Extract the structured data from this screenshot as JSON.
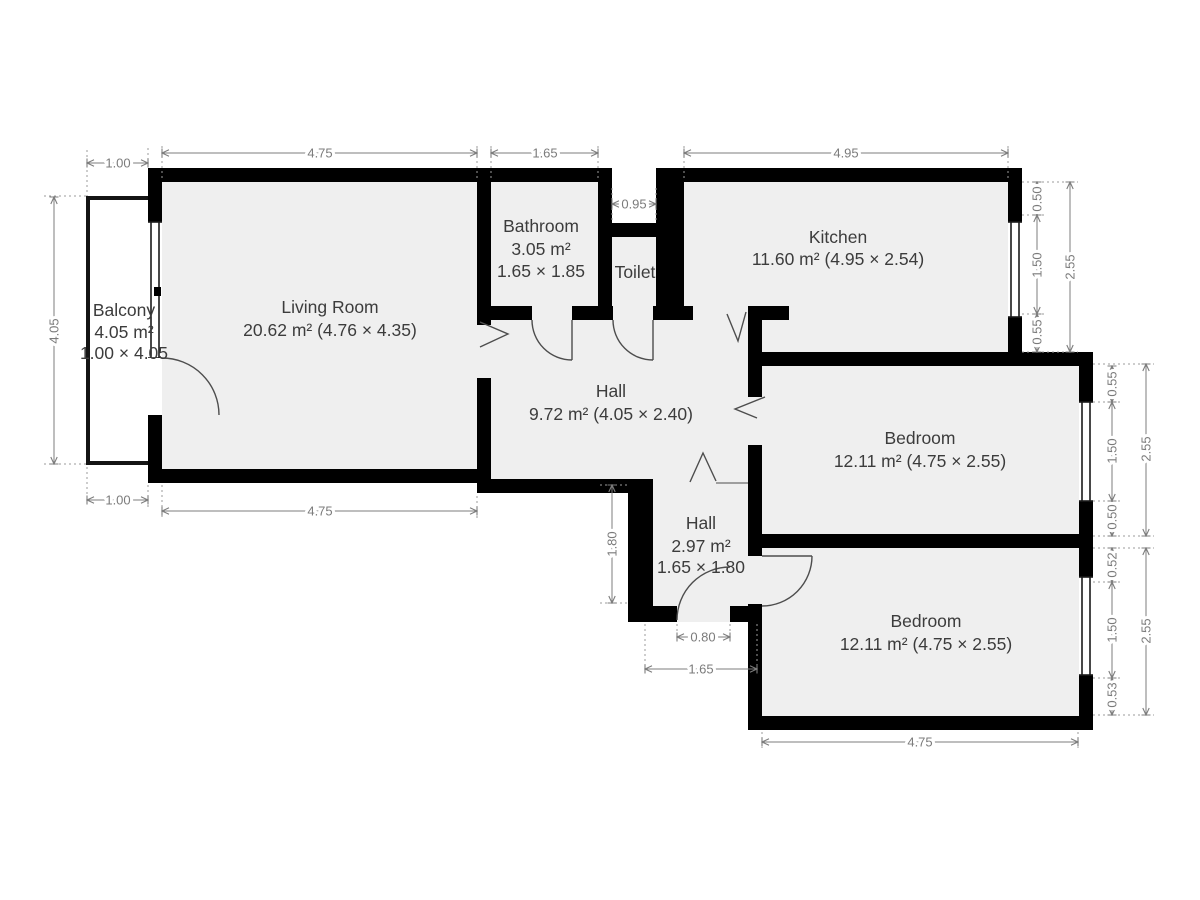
{
  "plan": {
    "rooms": {
      "balcony": {
        "name": "Balcony",
        "area": "4.05 m²",
        "size": "1.00 × 4.05"
      },
      "living_room": {
        "name": "Living Room",
        "area_size": "20.62 m² (4.76 × 4.35)"
      },
      "bathroom": {
        "name": "Bathroom",
        "area": "3.05 m²",
        "size": "1.65 × 1.85"
      },
      "toilet": {
        "name": "Toilet"
      },
      "kitchen": {
        "name": "Kitchen",
        "area_size": "11.60 m² (4.95 × 2.54)"
      },
      "hall": {
        "name": "Hall",
        "area_size": "9.72 m² (4.05 × 2.40)"
      },
      "hall_small": {
        "name": "Hall",
        "area": "2.97 m²",
        "size": "1.65 × 1.80"
      },
      "bedroom_top": {
        "name": "Bedroom",
        "area_size": "12.11 m² (4.75 × 2.55)"
      },
      "bedroom_bottom": {
        "name": "Bedroom",
        "area_size": "12.11 m² (4.75 × 2.55)"
      }
    },
    "dimensions": {
      "top": {
        "balcony_width": "1.00",
        "living_width": "4.75",
        "bathroom_width": "1.65",
        "toilet_recess": "0.95",
        "kitchen_width": "4.95"
      },
      "left": {
        "balcony_height": "4.05"
      },
      "bottom_left": {
        "balcony_width": "1.00",
        "living_width": "4.75"
      },
      "right_kitchen": {
        "seg1": "0.50",
        "seg2": "1.50",
        "seg3": "0.55",
        "total": "2.55"
      },
      "right_bedroom_top": {
        "seg1": "0.55",
        "seg2": "1.50",
        "seg3": "0.50",
        "total": "2.55"
      },
      "right_bedroom_bottom": {
        "seg1": "0.52",
        "seg2": "1.50",
        "seg3": "0.53",
        "total": "2.55"
      },
      "hall_small": {
        "height": "1.80",
        "door_width": "0.80",
        "width": "1.65"
      },
      "bottom": {
        "bedroom_width": "4.75"
      }
    },
    "colors": {
      "wall": "#000000",
      "room_fill": "#efefef",
      "dim_text": "#7b7b7b",
      "label_text": "#3c3c3c",
      "background": "#ffffff"
    }
  }
}
